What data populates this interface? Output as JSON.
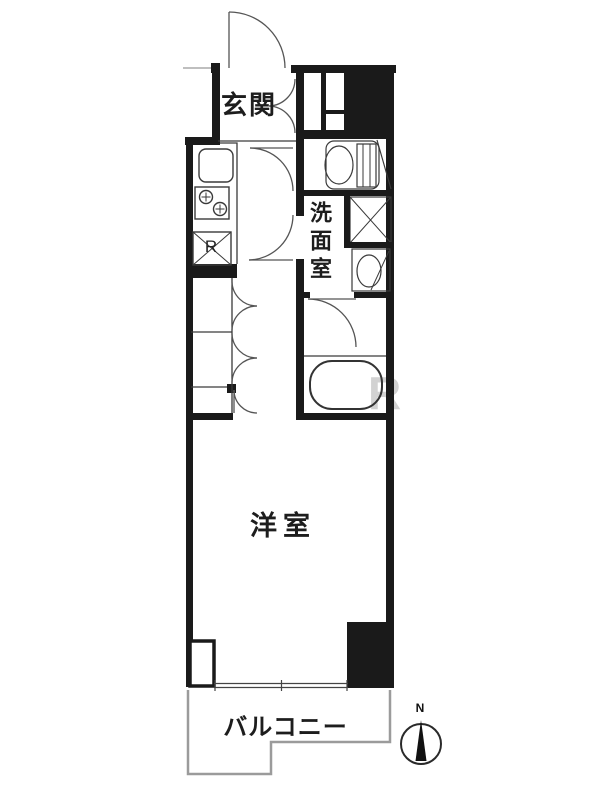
{
  "floorplan": {
    "rooms": {
      "entrance": "玄関",
      "washroom": "洗面室",
      "western_room": "洋室",
      "balcony": "バルコニー"
    },
    "labels": {
      "refrigerator": "R",
      "compass_north": "N"
    },
    "watermark": "R",
    "colors": {
      "wall": "#1a1a1a",
      "fixture_line": "#3a3a3a",
      "door_line": "#555555",
      "balcony_line": "#9b9b9b",
      "background": "#ffffff"
    }
  }
}
